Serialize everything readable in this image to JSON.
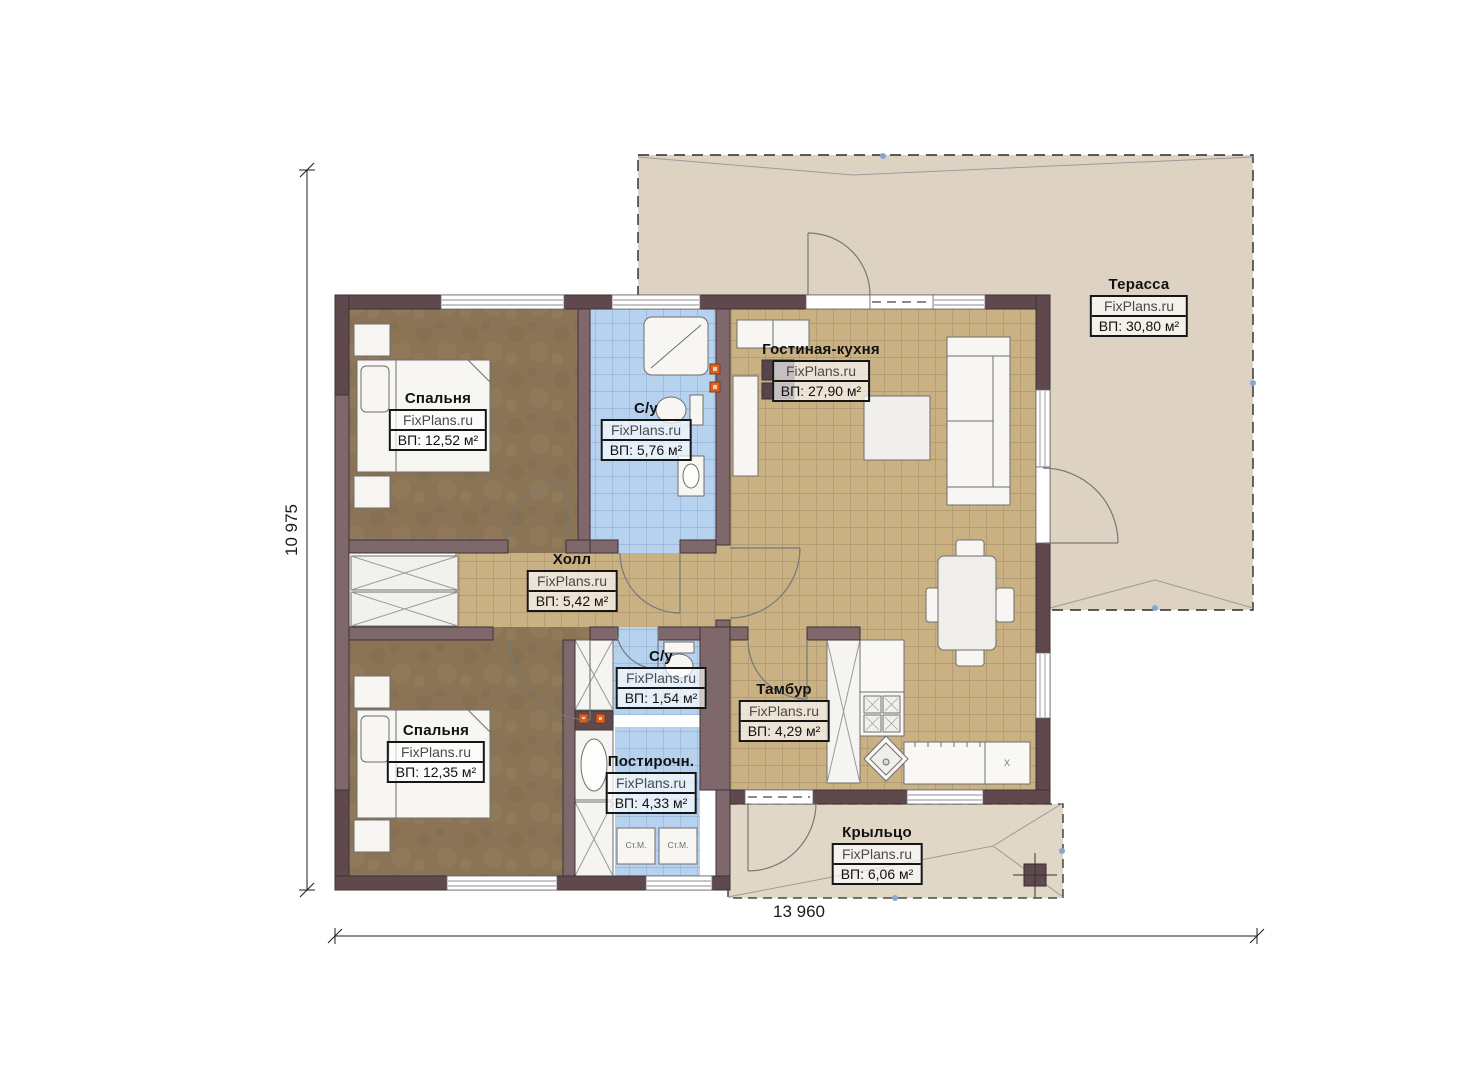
{
  "watermark": "FixPlans.ru",
  "rooms": {
    "bedroom_top": {
      "name": "Спальня",
      "area": "ВП: 12,52 м²"
    },
    "bathroom_main": {
      "name": "С/у",
      "area": "ВП: 5,76 м²"
    },
    "living_kitchen": {
      "name": "Гостиная-кухня",
      "area": "ВП: 27,90 м²"
    },
    "terrace": {
      "name": "Терасса",
      "area": "ВП: 30,80 м²"
    },
    "hall": {
      "name": "Холл",
      "area": "ВП: 5,42 м²"
    },
    "bathroom_small": {
      "name": "С/у",
      "area": "ВП: 1,54 м²"
    },
    "vestibule": {
      "name": "Тамбур",
      "area": "ВП: 4,29 м²"
    },
    "bedroom_bottom": {
      "name": "Спальня",
      "area": "ВП: 12,35 м²"
    },
    "laundry": {
      "name": "Постирочн.",
      "area": "ВП: 4,33 м²"
    },
    "porch": {
      "name": "Крыльцо",
      "area": "ВП: 6,06 м²"
    }
  },
  "dimensions": {
    "overall_width": "13 960",
    "overall_height": "10 975"
  },
  "appliances": {
    "washing_machine_1": "Ст.М.",
    "washing_machine_2": "Ст.М.",
    "fridge_mark": "x"
  },
  "colors": {
    "wall": "#7e686b",
    "wall_dark": "#5f494d",
    "floor_wood": "#8b7456",
    "tile_warm": "#cab184",
    "tile_blue": "#b6d2ef",
    "outdoor": "#ded3c2",
    "vent_orange": "#e2601c"
  }
}
